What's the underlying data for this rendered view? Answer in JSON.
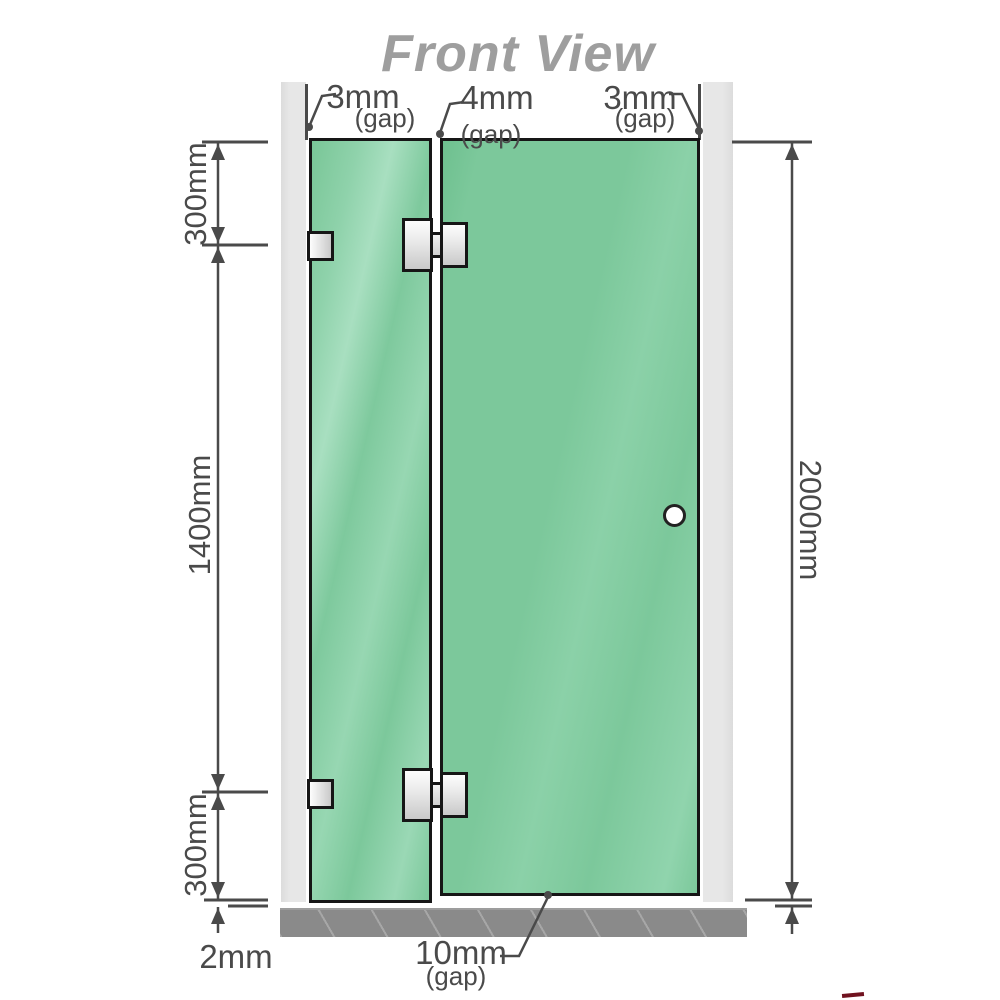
{
  "title": "Front View",
  "colors": {
    "glass_green": "#7CC89B",
    "glass_highlight": "#A8DFC0",
    "wall_gray": "#E7E7E7",
    "floor_gray": "#8A8A8A",
    "ink": "#4A4A4A",
    "title_gray": "#9E9E9E",
    "outline_black": "#161616"
  },
  "gap_labels": {
    "left": {
      "value": "3mm",
      "note": "(gap)"
    },
    "middle": {
      "value": "4mm",
      "note": "(gap)"
    },
    "right": {
      "value": "3mm",
      "note": "(gap)"
    },
    "bottom": {
      "value": "10mm",
      "note": "(gap)"
    },
    "floor_clearance": {
      "value": "2mm"
    }
  },
  "side_dimensions": {
    "left_top": "300mm",
    "left_middle": "1400mm",
    "left_bottom": "300mm",
    "right_total": "2000mm"
  }
}
